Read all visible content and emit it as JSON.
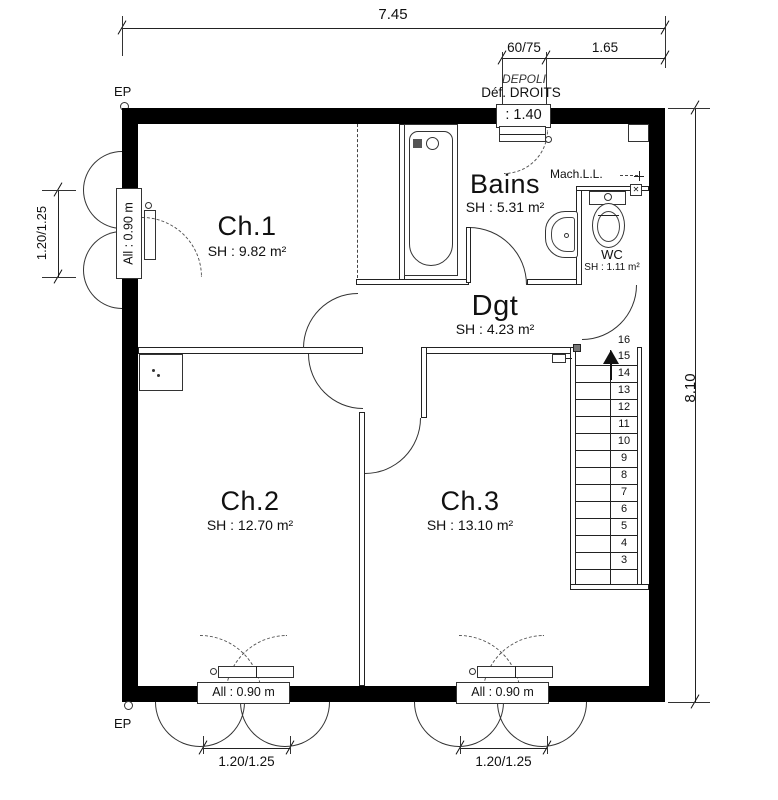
{
  "dimensions": {
    "top_total": "7.45",
    "top_window": "60/75",
    "top_right": "1.65",
    "window_height_box": ": 1.40",
    "right_total": "8.10",
    "left_window": "1.20/1.25",
    "bottom_window_1": "1.20/1.25",
    "bottom_window_2": "1.20/1.25"
  },
  "annotations": {
    "ep_top": "EP",
    "ep_bottom": "EP",
    "depoli": "DEPOLI",
    "def_droits": "Déf. DROITS",
    "machine": "Mach.L.L.",
    "window_left_label": "All : 0.90 m",
    "window_bottom1_label": "All : 0.90 m",
    "window_bottom2_label": "All : 0.90 m"
  },
  "rooms": {
    "ch1": {
      "name": "Ch.1",
      "area": "SH : 9.82 m²"
    },
    "ch2": {
      "name": "Ch.2",
      "area": "SH : 12.70 m²"
    },
    "ch3": {
      "name": "Ch.3",
      "area": "SH : 13.10 m²"
    },
    "bains": {
      "name": "Bains",
      "area": "SH : 5.31 m²"
    },
    "dgt": {
      "name": "Dgt",
      "area": "SH : 4.23 m²"
    },
    "wc": {
      "name": "WC",
      "area": "SH : 1.11 m²"
    }
  },
  "stairs": {
    "top_step": "16",
    "steps": [
      "15",
      "14",
      "13",
      "12",
      "11",
      "10",
      "9",
      "8",
      "7",
      "6",
      "5",
      "4",
      "3"
    ]
  }
}
